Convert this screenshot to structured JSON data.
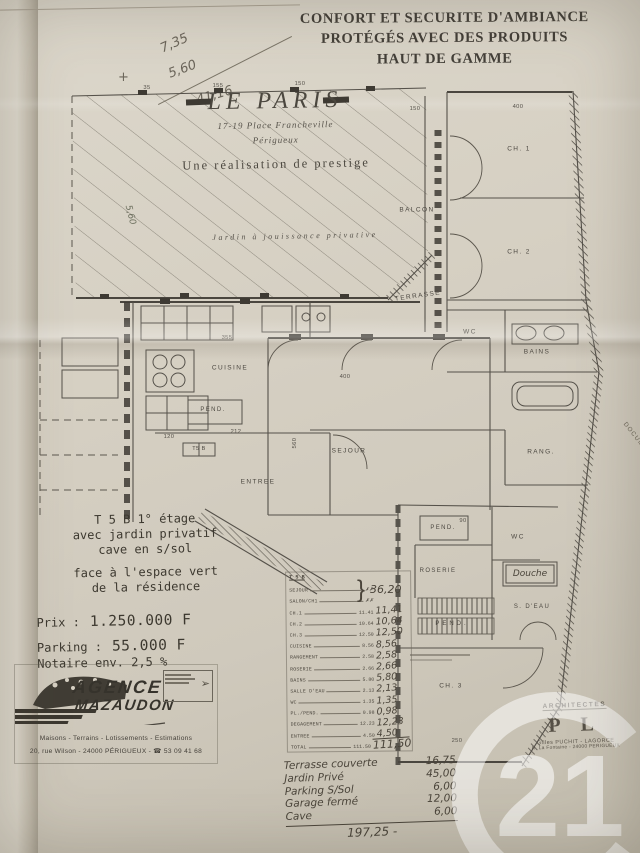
{
  "header": {
    "line1": "CONFORT ET SECURITE D'AMBIANCE",
    "line2": "PROTÉGÉS AVEC DES PRODUITS",
    "line3": "HAUT DE GAMME"
  },
  "annotations": {
    "calc_plus": "+",
    "calc_v1": "7,35",
    "calc_v2": "5,60",
    "calc_result": "41,16",
    "margin_note": "5,60"
  },
  "plan": {
    "title": "LE PARIS",
    "address_line1": "17-19 Place Francheville",
    "address_line2": "Périgueux",
    "tagline": "Une réalisation de prestige",
    "garden_label": "Jardin à jouissance privative",
    "unit_tag": "T5 B",
    "side_note": "DOCUMENT NON CONTRACTUEL",
    "rooms": [
      "CH. 1",
      "CH. 2",
      "BALCON",
      "TERRASSE",
      "WC",
      "BAINS",
      "RANG.",
      "CUISINE",
      "SEJOUR",
      "PEND.",
      "ENTREE",
      "PEND.",
      "WC",
      "Douche",
      "S. D'EAU",
      "ROSERIE",
      "PEND.",
      "CH. 3"
    ],
    "dims": [
      "355",
      "400",
      "560",
      "120",
      "212",
      "150",
      "400",
      "90",
      "250",
      "35",
      "155",
      "150"
    ]
  },
  "listing": {
    "l1": "T 5 B   1° étage",
    "l2": "avec jardin privatif",
    "l3": "cave en s/sol",
    "l4": "face à l'espace vert",
    "l5": "de la résidence",
    "price_label": "Prix :",
    "price_value": "1.250.000 F",
    "parking_label": "Parking :",
    "parking_value": "55.000 F",
    "notary": "Notaire env. 2,5 %"
  },
  "agency": {
    "name1": "AGENCE",
    "name2": "MAZAUDON",
    "tagline": "Maisons - Terrains - Lotissements - Estimations",
    "address": "20, rue Wilson - 24000 PÉRIGUEUX - ☎ 53 09 41 68"
  },
  "areas": {
    "header": "T 5 B",
    "brace_value": "36,20",
    "rows": [
      {
        "label": "SEJOUR",
        "typed": "✗✗",
        "hand": ""
      },
      {
        "label": "SALON/CH1",
        "typed": "✗✗",
        "hand": ""
      },
      {
        "label": "CH.1",
        "typed": "11.41",
        "hand": "11,41"
      },
      {
        "label": "CH.2",
        "typed": "10.64",
        "hand": "10,64"
      },
      {
        "label": "CH.3",
        "typed": "12.50",
        "hand": "12,50"
      },
      {
        "label": "CUISINE",
        "typed": "8.56",
        "hand": "8,56"
      },
      {
        "label": "RANGEMENT",
        "typed": "2.58",
        "hand": "2,58"
      },
      {
        "label": "ROSERIE",
        "typed": "2.66",
        "hand": "2,66"
      },
      {
        "label": "BAINS",
        "typed": "5.80",
        "hand": "5,80"
      },
      {
        "label": "SALLE D'EAU",
        "typed": "2.13",
        "hand": "2,13"
      },
      {
        "label": "WC",
        "typed": "1.35",
        "hand": "1,35"
      },
      {
        "label": "PL./PEND.",
        "typed": "0.98",
        "hand": "0,98"
      },
      {
        "label": "DEGAGEMENT",
        "typed": "12.23",
        "hand": "12,23"
      },
      {
        "label": "ENTREE",
        "typed": "4.50",
        "hand": "4,50"
      },
      {
        "label": "TOTAL",
        "typed": "111.50",
        "hand": "111,50"
      }
    ]
  },
  "extras": {
    "rows": [
      {
        "label": "Terrasse couverte",
        "value": "16,75"
      },
      {
        "label": "Jardin Privé",
        "value": "45,00"
      },
      {
        "label": "Parking S/Sol",
        "value": "6,00"
      },
      {
        "label": "Garage fermé",
        "value": "12,00"
      },
      {
        "label": "Cave",
        "value": "6,00"
      }
    ],
    "total": "197,25 -"
  },
  "architect": {
    "heading": "ARCHITECTES",
    "logo": "P L",
    "line1": "Gilles PUCHIT - LAGORCE",
    "line2": "R. La Fontaine - 24000 PERIGUEUX"
  },
  "watermark": {
    "number": "21"
  }
}
